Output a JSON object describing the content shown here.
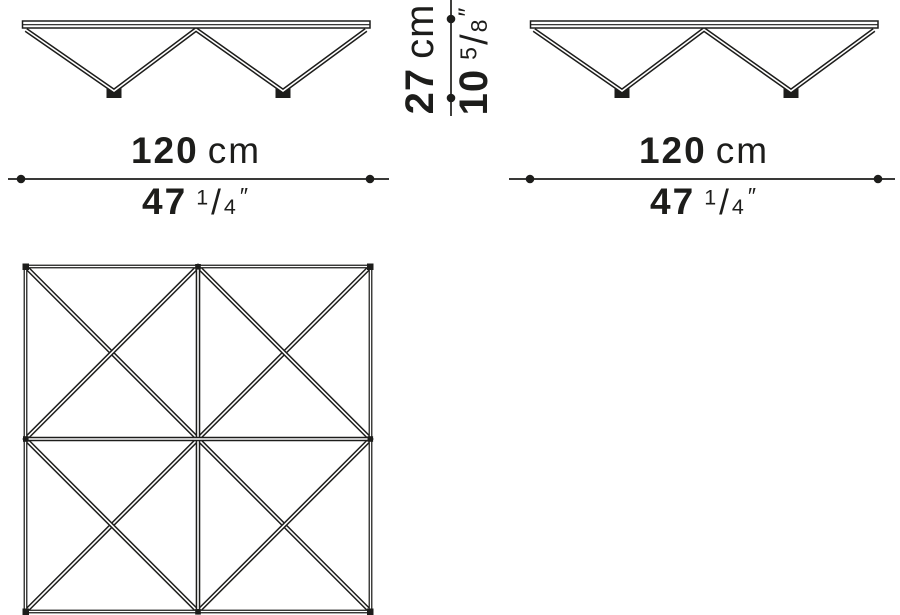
{
  "page": {
    "background_color": "#ffffff",
    "line_color": "#1d1d1b",
    "text_color": "#1d1d1b"
  },
  "dimensions": {
    "front_width": {
      "cm_value": "120",
      "cm_unit": "cm",
      "in_whole": "47",
      "in_num": "1",
      "in_den": "4",
      "in_mark": "″"
    },
    "side_width": {
      "cm_value": "120",
      "cm_unit": "cm",
      "in_whole": "47",
      "in_num": "1",
      "in_den": "4",
      "in_mark": "″"
    },
    "height": {
      "cm_value": "27",
      "cm_unit": "cm",
      "in_whole": "10",
      "in_num": "5",
      "in_den": "8",
      "in_mark": "″"
    }
  }
}
